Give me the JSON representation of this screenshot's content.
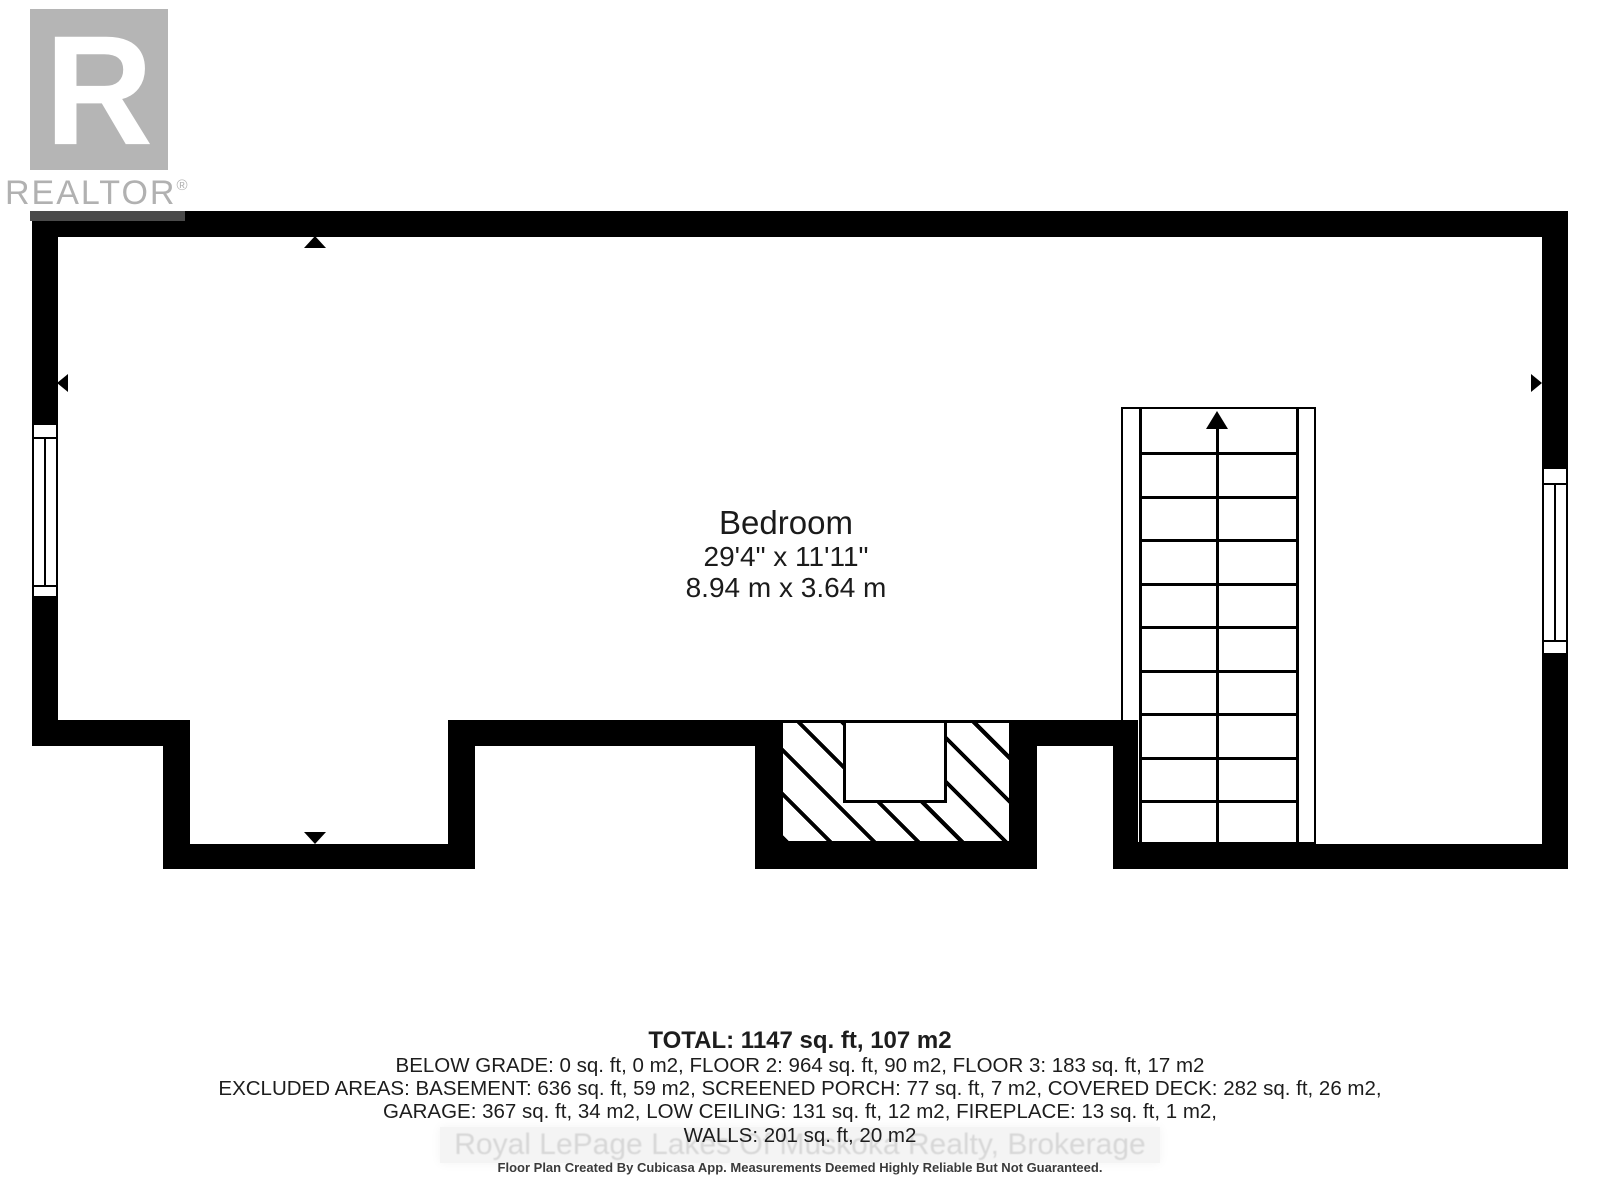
{
  "logo": {
    "letter": "R",
    "name": "REALTOR",
    "reg": "®"
  },
  "room": {
    "name": "Bedroom",
    "dimensions_imperial": "29'4\" x 11'11\"",
    "dimensions_metric": "8.94 m x 3.64 m"
  },
  "summary": {
    "total": "TOTAL: 1147 sq. ft, 107 m2",
    "line2": "BELOW GRADE: 0 sq. ft, 0 m2, FLOOR 2: 964 sq. ft, 90 m2, FLOOR 3: 183 sq. ft, 17 m2",
    "line3": "EXCLUDED AREAS: BASEMENT: 636 sq. ft, 59 m2, SCREENED PORCH: 77 sq. ft, 7 m2, COVERED DECK: 282 sq. ft, 26 m2,",
    "line4": "GARAGE: 367 sq. ft, 34 m2, LOW CEILING: 131 sq. ft, 12 m2, FIREPLACE: 13 sq. ft, 1 m2,",
    "line5": "WALLS: 201 sq. ft, 20 m2"
  },
  "watermark": "Royal LePage Lakes Of Muskoka Realty, Brokerage",
  "disclaimer": "Floor Plan Created By Cubicasa App. Measurements Deemed Highly Reliable But Not Guaranteed.",
  "colors": {
    "wall": "#000000",
    "background": "#ffffff",
    "logo_gray": "#b5b5b5",
    "logo_text_gray": "#b1b1b1",
    "watermark_gray": "#d7d7d7",
    "text": "#1d1d1d"
  }
}
